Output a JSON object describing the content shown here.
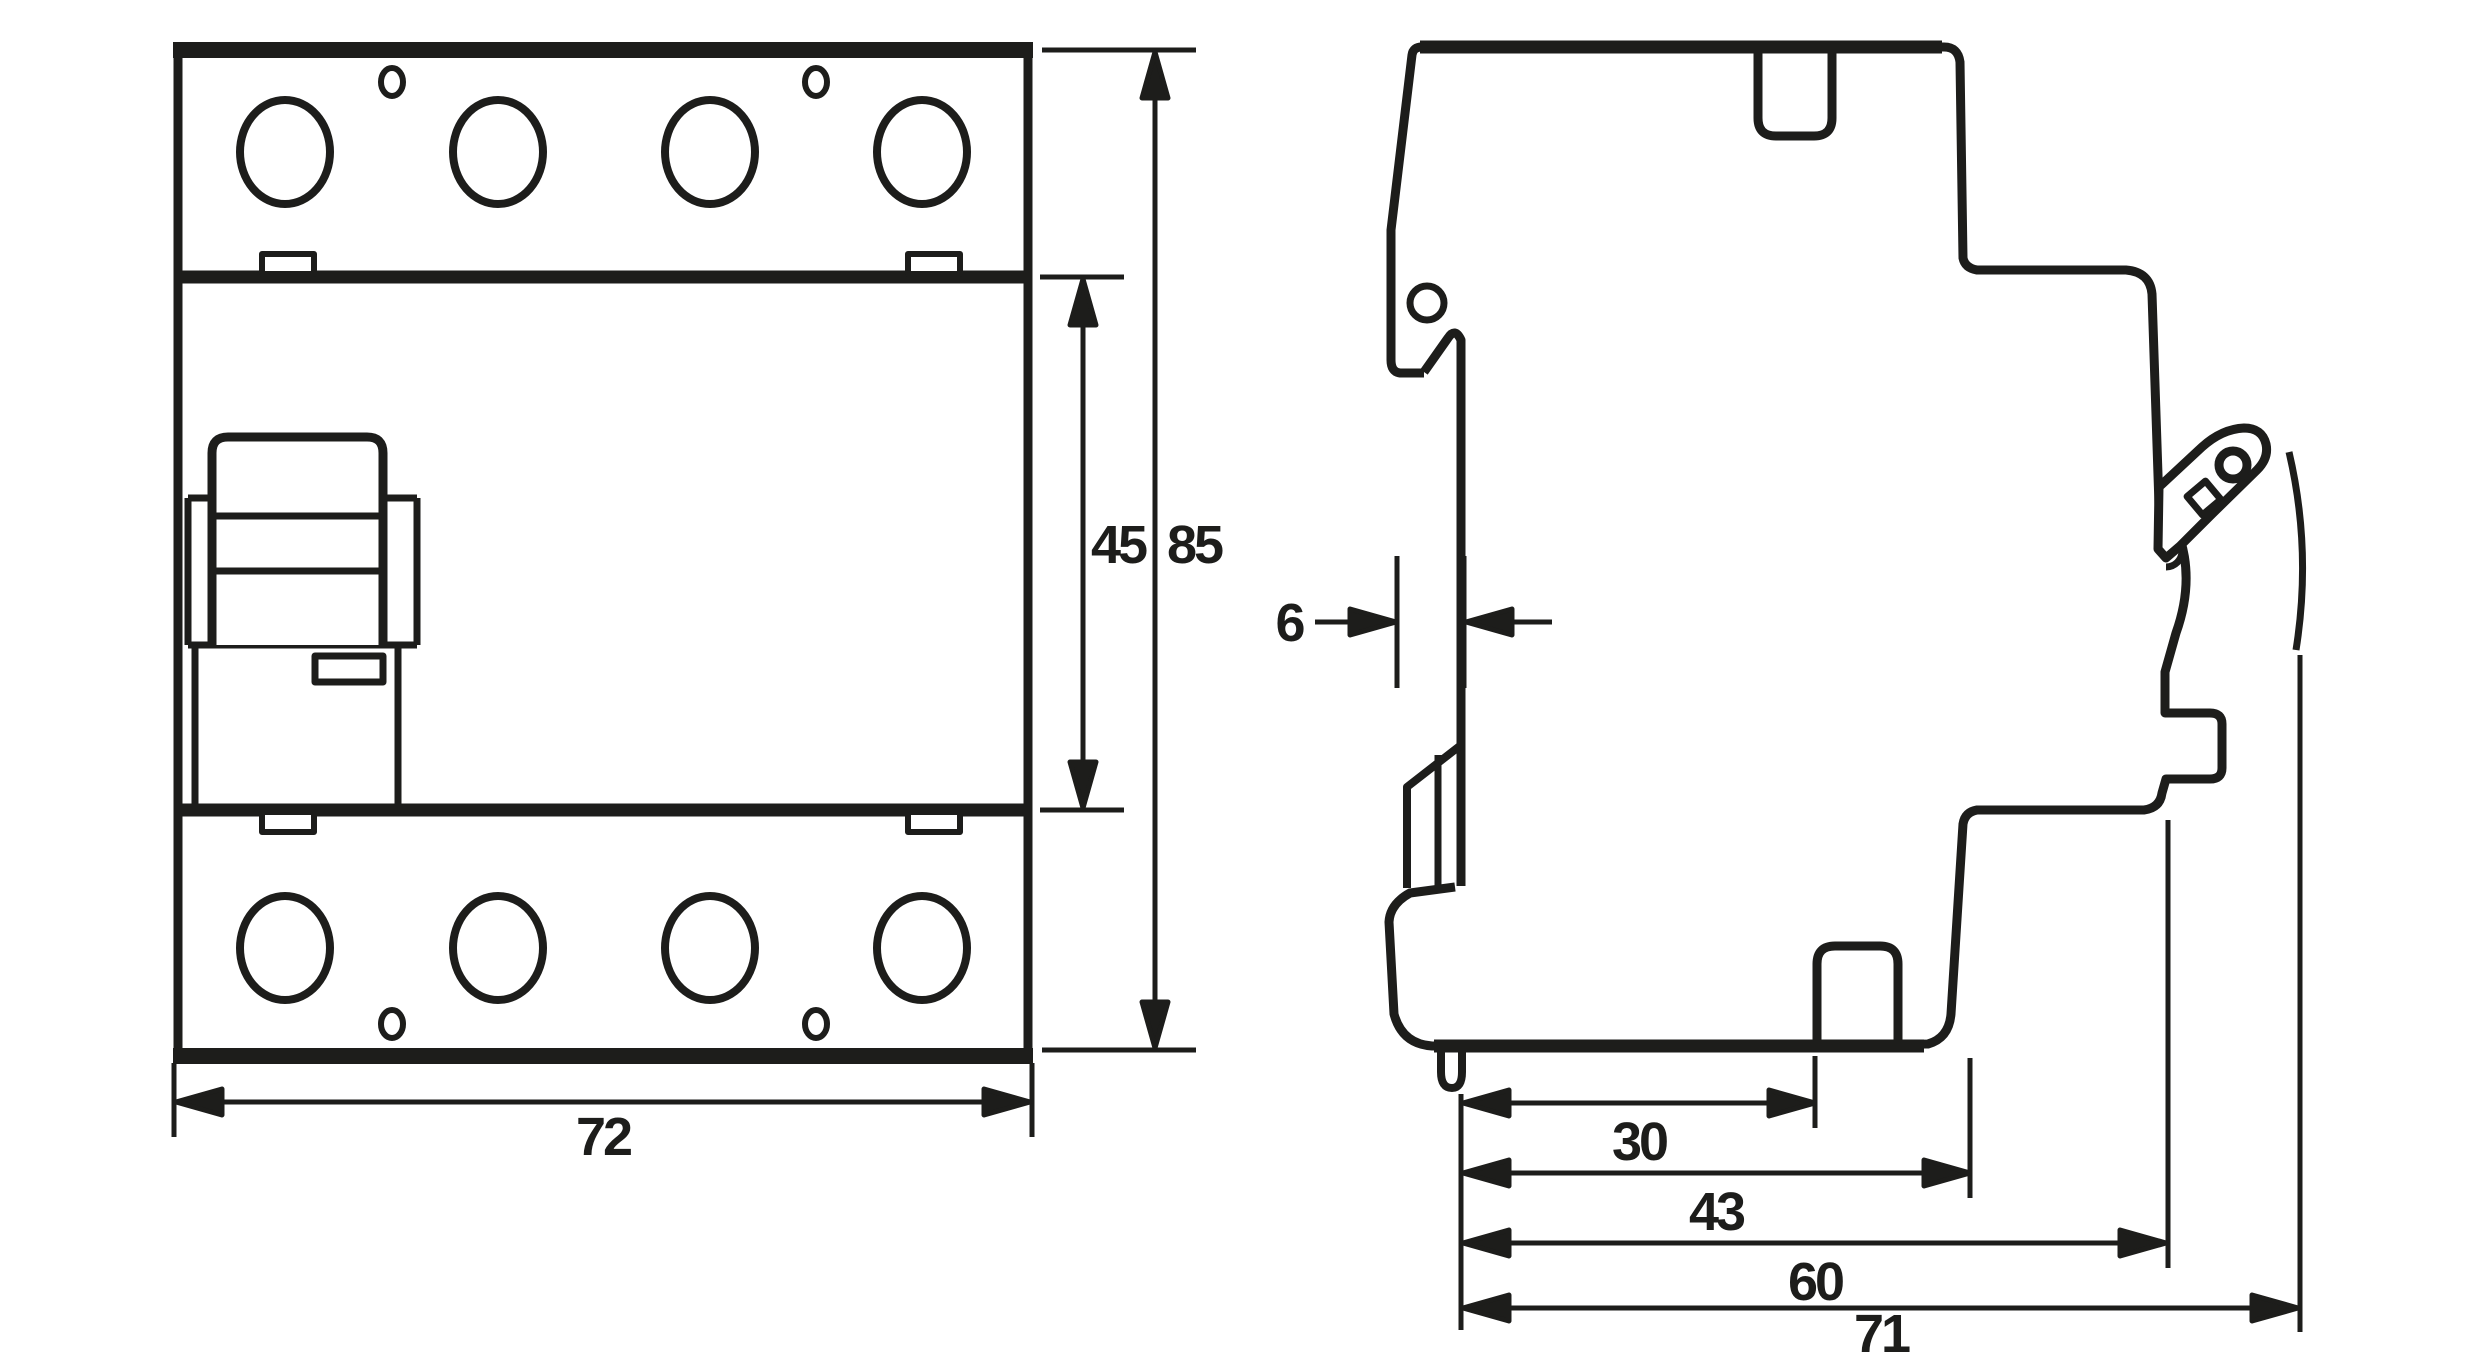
{
  "diagram": {
    "type": "technical-dimension-drawing",
    "subject": "4-pole DIN-rail device (RCCB) front and side views",
    "units": "mm",
    "colors": {
      "ink": "#1d1d1b",
      "paper": "#ffffff"
    },
    "dimensions": {
      "front_width": "72",
      "front_body_height": "45",
      "front_total_height": "85",
      "rail_recess_depth": "6",
      "depth_to_bottom_notch": "30",
      "depth_terminal_section": "43",
      "depth_body": "60",
      "depth_total": "71"
    }
  }
}
